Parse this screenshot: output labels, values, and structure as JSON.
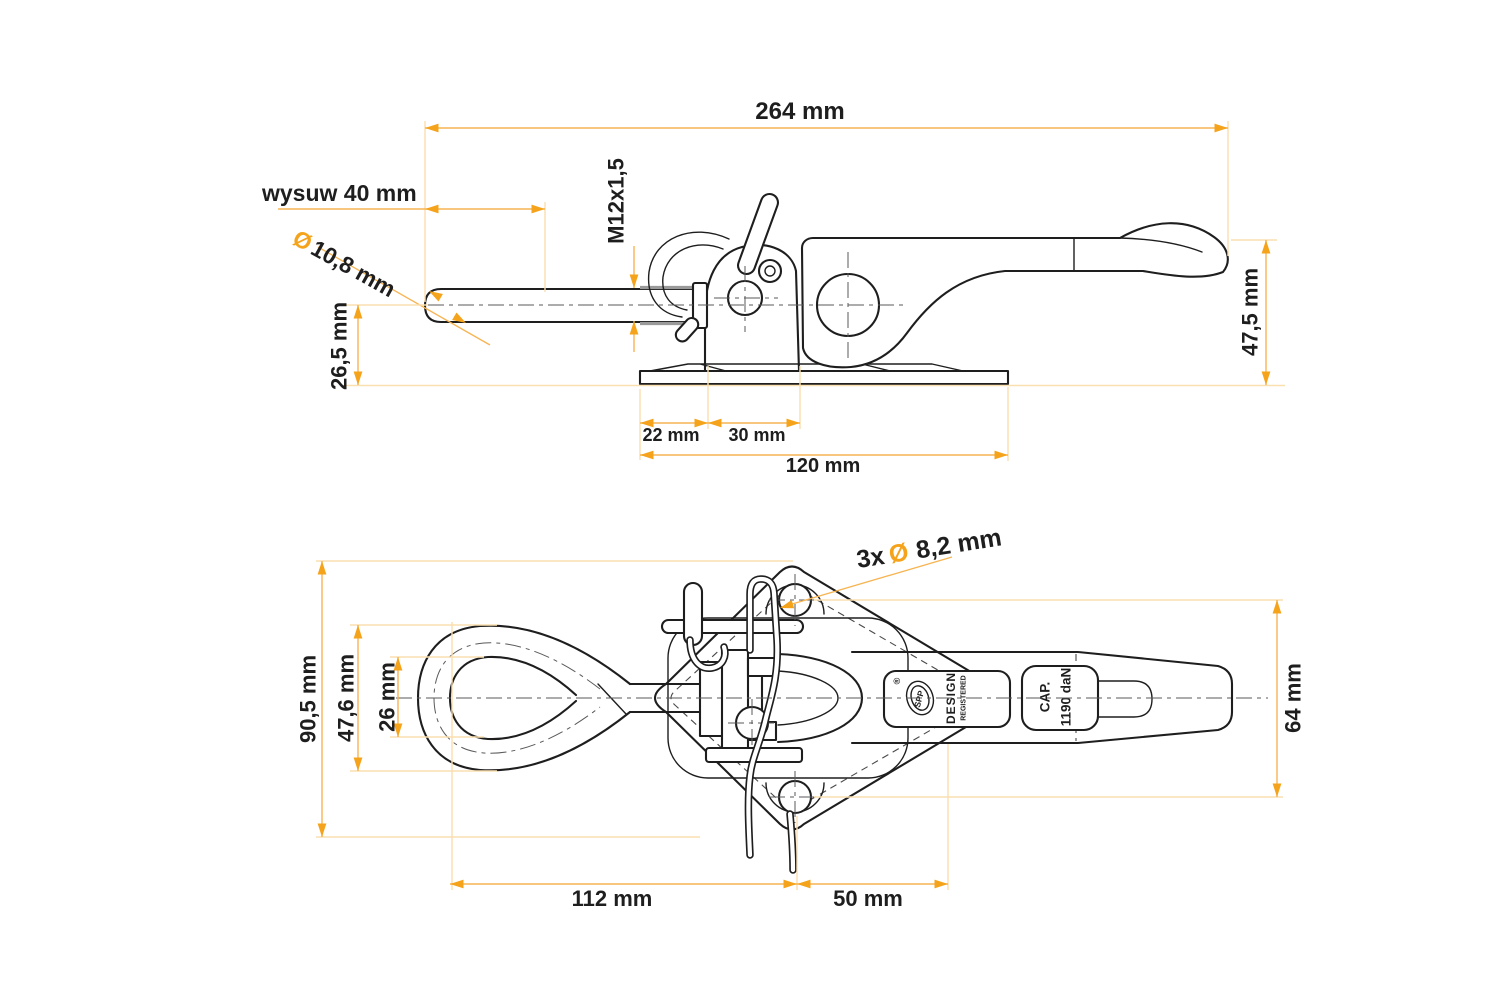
{
  "drawing": {
    "colors": {
      "outline": "#1e1e1e",
      "dimension_accent": "#F5A31B",
      "dimension_line": "#F7B452",
      "extension_line": "#FADFAF"
    },
    "side_view": {
      "overall_length": "264 mm",
      "stroke_label": "wysuw 40 mm",
      "rod_dia_symbol": "Ø",
      "rod_dia": "10,8 mm",
      "thread": "M12x1,5",
      "axis_height": "26,5 mm",
      "base_hole_offset": "22 mm",
      "base_hole_spacing": "30 mm",
      "base_length": "120 mm",
      "overall_height": "47,5 mm"
    },
    "plan_view": {
      "holes_count": "3x",
      "holes_dia_symbol": "Ø",
      "holes_dia": "8,2 mm",
      "plate_width": "90,5 mm",
      "eye_outer_width": "47,6 mm",
      "eye_inner_width": "26 mm",
      "lever_span": "64 mm",
      "eye_to_hole": "112 mm",
      "hole_to_end": "50 mm",
      "stamps": {
        "reg_mark": "®",
        "logo": "SPP",
        "design": "DESIGN",
        "registered": "REGISTERED",
        "cap": "CAP.",
        "cap_value": "1190 daN"
      }
    }
  }
}
